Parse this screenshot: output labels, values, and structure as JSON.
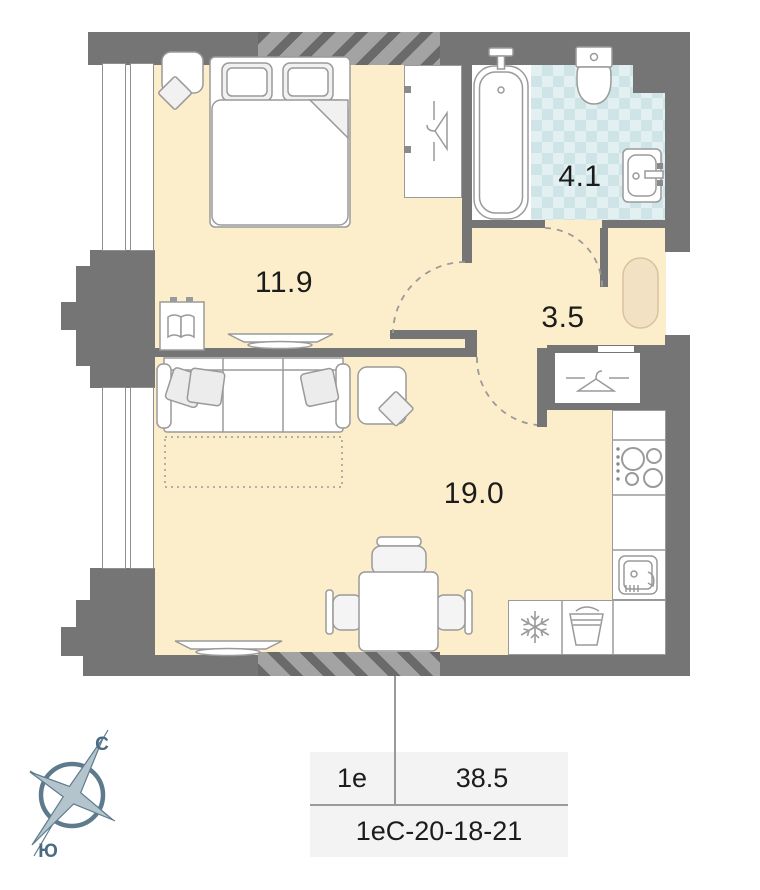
{
  "plan": {
    "rooms": [
      {
        "id": "bedroom",
        "area_label": "11.9"
      },
      {
        "id": "bathroom",
        "area_label": "4.1"
      },
      {
        "id": "hallway",
        "area_label": "3.5"
      },
      {
        "id": "living-kitchen",
        "area_label": "19.0"
      }
    ],
    "compass": {
      "north_label": "С",
      "south_label": "Ю"
    },
    "info_table": {
      "layout_code": "1е",
      "total_area": "38.5",
      "apartment_code": "1еС-20-18-21"
    },
    "colors": {
      "wall": "#757575",
      "floor": "#fdeecb",
      "tile_light": "#e3f0f1",
      "tile_dark": "#cfe4e7",
      "furniture_stroke": "#9a9a9a",
      "compass": "#5d7b8d",
      "compass_text": "#4a6b80",
      "doormat": "#f2e2c3",
      "table_bg": "#f3f3f3",
      "text": "#1c1c1c"
    }
  }
}
